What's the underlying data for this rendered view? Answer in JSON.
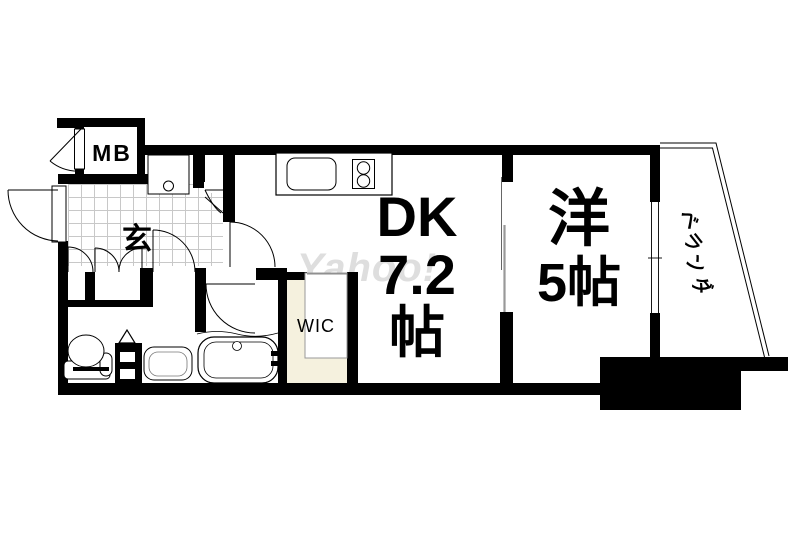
{
  "floorplan": {
    "labels": {
      "meter_box": "MB",
      "entrance": "玄",
      "dk": [
        "DK",
        "7.2",
        "帖"
      ],
      "western_room": [
        "洋",
        "5帖"
      ],
      "walk_in_closet": "WIC",
      "veranda": [
        "ベ",
        "ラ",
        "ン",
        "ダ"
      ],
      "watermark": "Yahoo!"
    },
    "colors": {
      "wall": "#000000",
      "wic_floor": "#f5f1de",
      "tile_grid_line": "#c8c8c8",
      "watermark": "#dedede"
    }
  }
}
